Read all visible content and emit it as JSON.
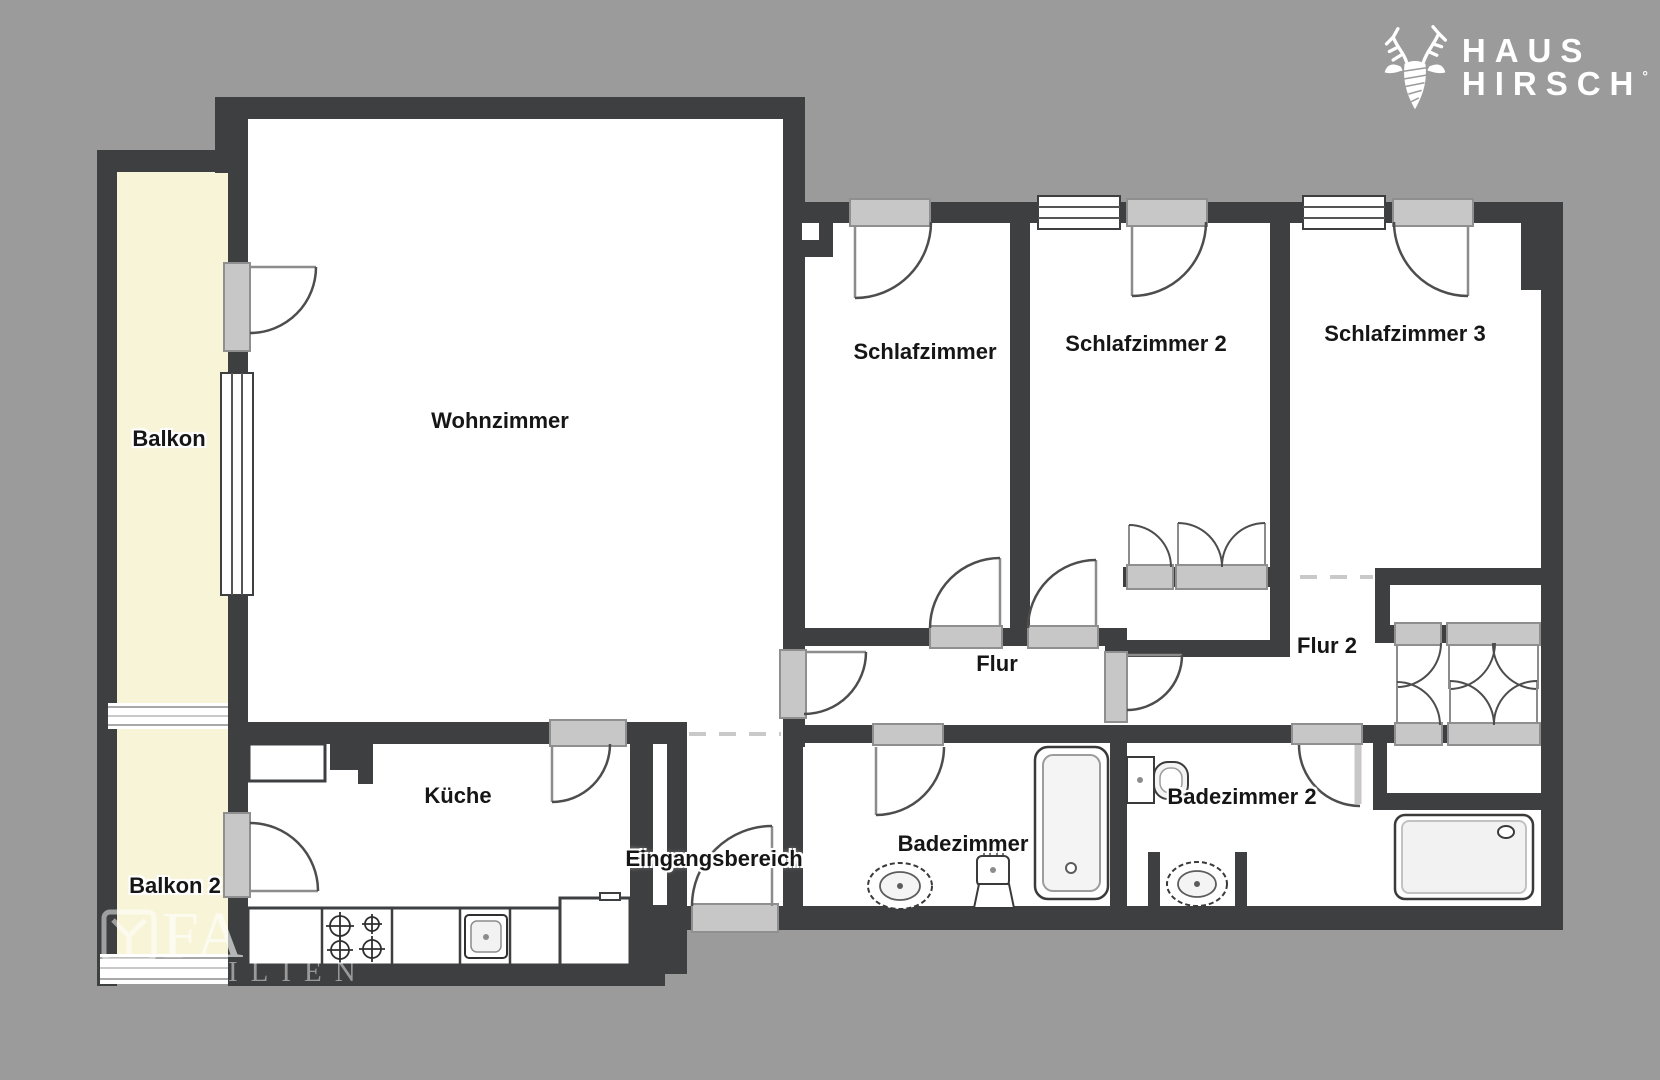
{
  "page": {
    "kind": "real-estate floor plan screenshot",
    "background_color": "#9b9b9b"
  },
  "logo": {
    "icon": "deer-antlers-icon",
    "line1": "HAUS",
    "line2": "HIRSCH",
    "registered_mark": "°",
    "color": "#ffffff"
  },
  "watermark": {
    "icon": "shield-y-icon",
    "large_text": "FA",
    "small_text": "ILIEN"
  },
  "palette": {
    "wall": "#3e3f40",
    "floor": "#ffffff",
    "balcony_fill": "#f8f4d8",
    "door_opening": "#c7c7c7",
    "door_swing_line": "#4d4d4d",
    "dashed_opening": "#c9c9c9"
  },
  "rooms": [
    {
      "id": "balkon",
      "label": "Balkon",
      "x": 169,
      "y": 439
    },
    {
      "id": "balkon-2",
      "label": "Balkon 2",
      "x": 175,
      "y": 886
    },
    {
      "id": "wohnzimmer",
      "label": "Wohnzimmer",
      "x": 500,
      "y": 421
    },
    {
      "id": "kueche",
      "label": "Küche",
      "x": 458,
      "y": 796
    },
    {
      "id": "eingangsbereich",
      "label": "Eingangsbereich",
      "x": 714,
      "y": 859
    },
    {
      "id": "schlafzimmer",
      "label": "Schlafzimmer",
      "x": 925,
      "y": 352
    },
    {
      "id": "schlafzimmer-2",
      "label": "Schlafzimmer 2",
      "x": 1146,
      "y": 344
    },
    {
      "id": "schlafzimmer-3",
      "label": "Schlafzimmer 3",
      "x": 1405,
      "y": 334
    },
    {
      "id": "flur",
      "label": "Flur",
      "x": 997,
      "y": 664
    },
    {
      "id": "flur-2",
      "label": "Flur 2",
      "x": 1327,
      "y": 646
    },
    {
      "id": "badezimmer",
      "label": "Badezimmer",
      "x": 963,
      "y": 844
    },
    {
      "id": "badezimmer-2",
      "label": "Badezimmer 2",
      "x": 1242,
      "y": 797
    }
  ],
  "fixtures": [
    "stove-icon",
    "kitchen-sink-icon",
    "bathtub-icon",
    "toilet-icon",
    "pedestal-sink-icon",
    "toilet-2-icon",
    "wall-sink-icon",
    "shower-tray-icon"
  ]
}
